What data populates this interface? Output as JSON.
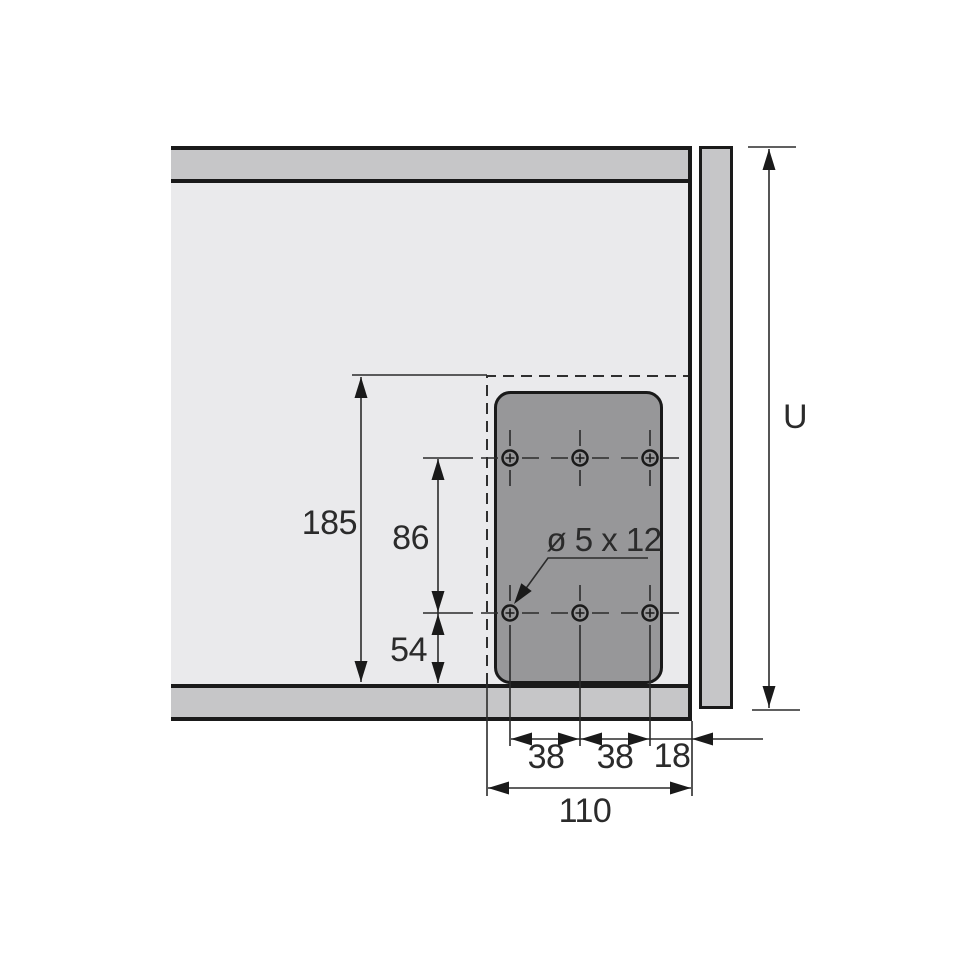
{
  "drawing": {
    "labels": {
      "plate_height": "185",
      "hole_row_spacing": "86",
      "bottom_offset": "54",
      "hole_col_spacing_1": "38",
      "hole_col_spacing_2": "38",
      "edge_offset": "18",
      "total_width": "110",
      "panel_height": "U",
      "hole_spec": "ø 5 x 12"
    },
    "colors": {
      "background": "#ffffff",
      "panel": "#eaeaec",
      "rail": "#c6c6c8",
      "plate": "#979799",
      "outline": "#1a1a1a",
      "dimension": "#2b2b2b"
    }
  }
}
